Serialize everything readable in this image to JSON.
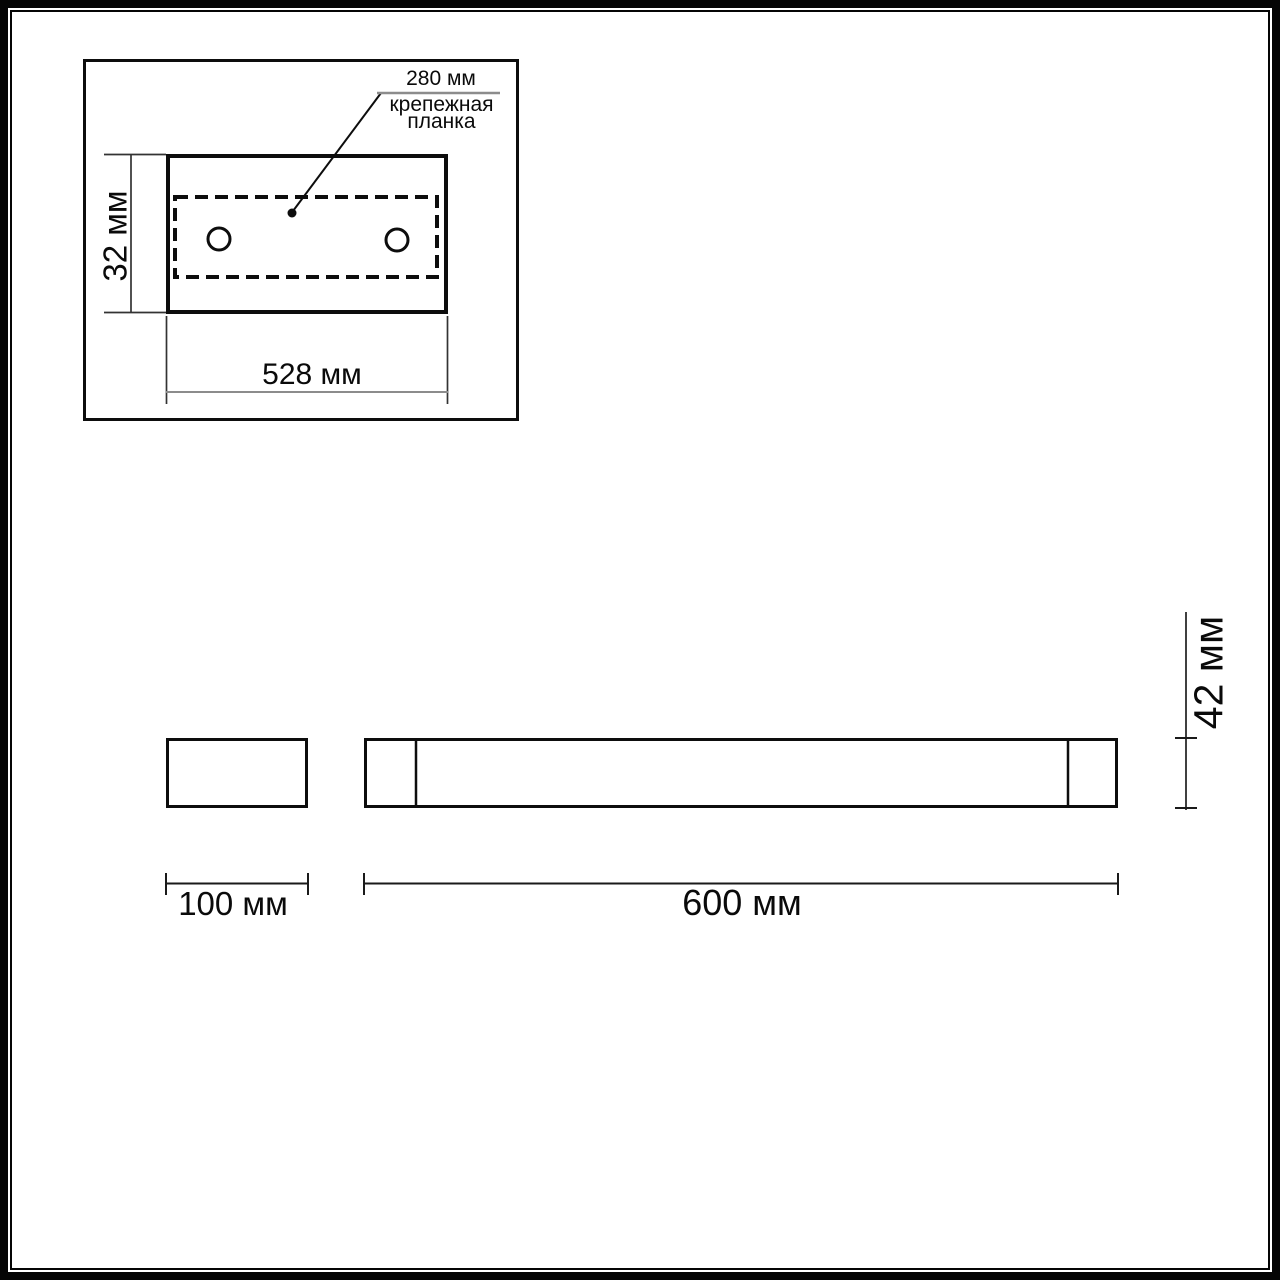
{
  "drawing": {
    "title_hint": "wall luminaire dimension drawing",
    "top_view": {
      "callout_dimension": "280 мм",
      "callout_label": "крепежная планка",
      "height_dimension": "32 мм",
      "width_dimension": "528 мм",
      "mounting_holes_count": 2
    },
    "side_view": {
      "width_dimension": "100 мм"
    },
    "front_view": {
      "width_dimension": "600 мм",
      "height_dimension": "42 мм"
    },
    "colors": {
      "line": "#0d0d0d",
      "dim_gray": "#8c8c8c",
      "background": "#ffffff"
    }
  }
}
